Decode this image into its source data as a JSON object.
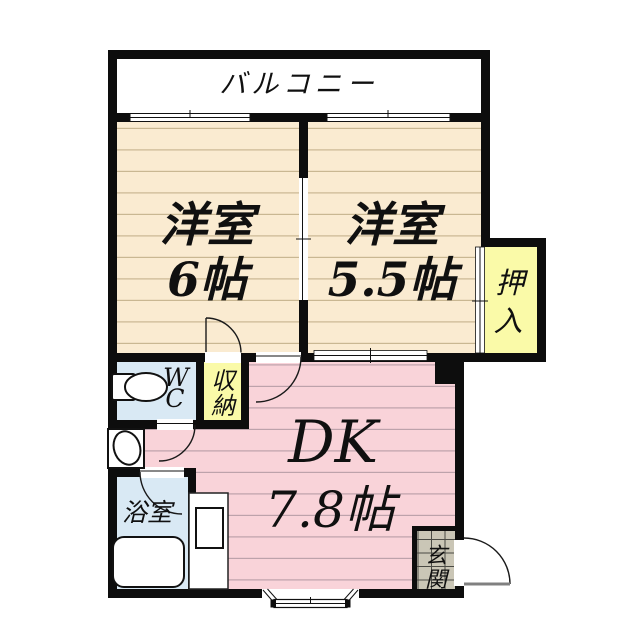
{
  "plan": {
    "balcony": {
      "label": "バルコニー"
    },
    "room_nw": {
      "name": "洋室",
      "size": "6帖"
    },
    "room_ne": {
      "name": "洋室",
      "size": "5.5帖"
    },
    "closet": {
      "char1": "押",
      "char2": "入"
    },
    "wc": {
      "char1": "W",
      "char2": "C"
    },
    "storage": {
      "char1": "収",
      "char2": "納"
    },
    "dk": {
      "name": "DK",
      "size": "7.8帖"
    },
    "bathroom": {
      "label": "浴室"
    },
    "entrance": {
      "char1": "玄",
      "char2": "関"
    }
  },
  "colors": {
    "wall": "#0d0d0d",
    "room_floor": "#faebd1",
    "room_floor_line": "#c9b792",
    "dk_floor": "#f9d3d9",
    "dk_floor_line": "#bda2ab",
    "wet_room_floor": "#d9e9f4",
    "closet_floor": "#fafaa8",
    "entrance_floor": "#cac6b6",
    "entrance_grid_line": "#4a4a44"
  }
}
